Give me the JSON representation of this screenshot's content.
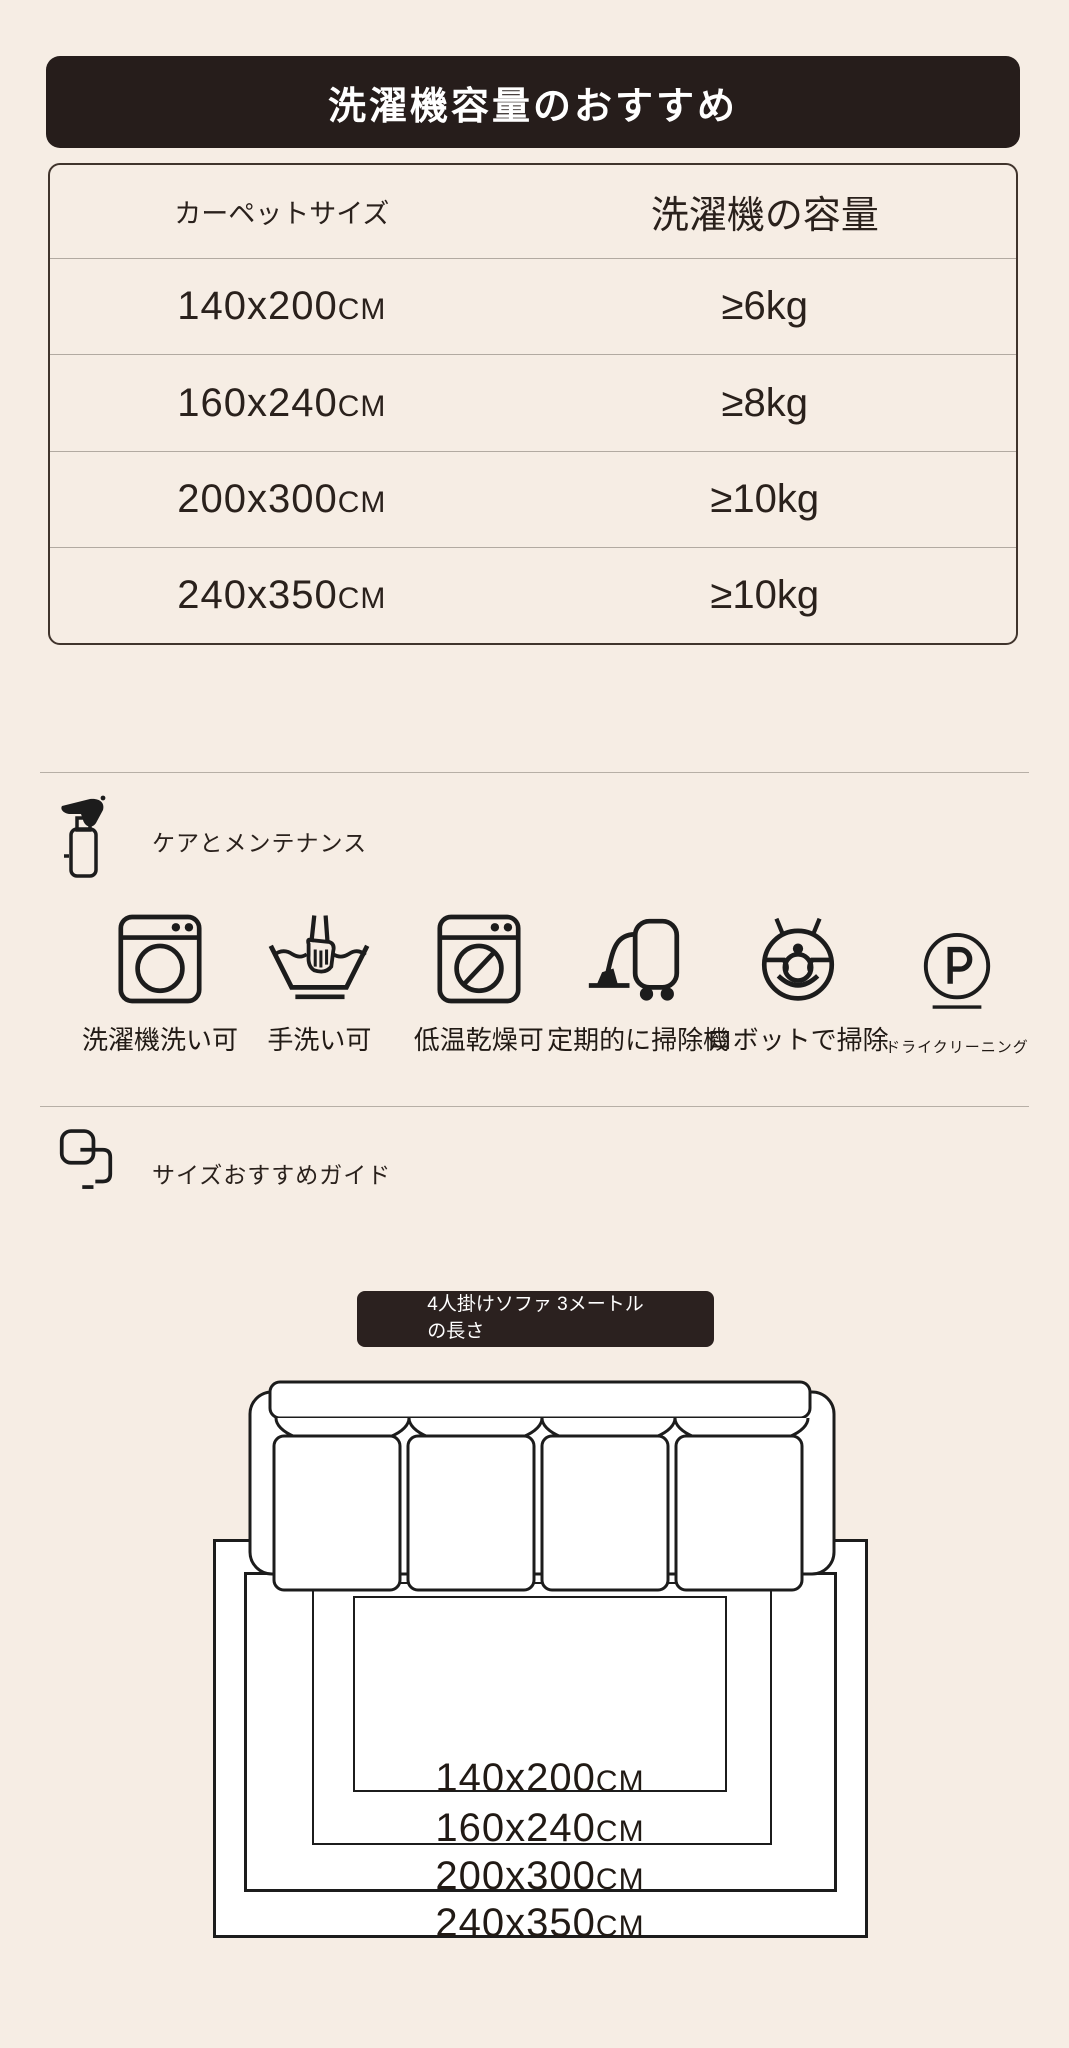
{
  "colors": {
    "background": "#f6ede4",
    "banner_bg": "#261d1b",
    "tooltip_bg": "#2b211f",
    "text": "#2a211c",
    "line": "#b7afa6"
  },
  "banner": {
    "title": "洗濯機容量のおすすめ"
  },
  "table": {
    "columns": {
      "size": "カーペットサイズ",
      "capacity": "洗濯機の容量"
    },
    "rows": [
      {
        "size": "140x200",
        "unit": "CM",
        "capacity": "≥6kg"
      },
      {
        "size": "160x240",
        "unit": "CM",
        "capacity": "≥8kg"
      },
      {
        "size": "200x300",
        "unit": "CM",
        "capacity": "≥10kg"
      },
      {
        "size": "240x350",
        "unit": "CM",
        "capacity": "≥10kg"
      }
    ]
  },
  "care": {
    "title": "ケアとメンテナンス",
    "items": [
      {
        "icon": "washing-machine-icon",
        "label": "洗濯機洗い可"
      },
      {
        "icon": "hand-wash-icon",
        "label": "手洗い可"
      },
      {
        "icon": "tumble-dry-low-icon",
        "label": "低温乾燥可"
      },
      {
        "icon": "vacuum-cleaner-icon",
        "label": "定期的に掃除機"
      },
      {
        "icon": "robot-vacuum-icon",
        "label": "ロボットで掃除"
      },
      {
        "icon": "dry-cleaning-icon",
        "label": "ドライクリーニング"
      }
    ]
  },
  "size_guide": {
    "title": "サイズおすすめガイド",
    "sofa_note": "4人掛けソファ 3メートル\nの長さ",
    "carpets": [
      {
        "size": "140x200",
        "unit": "CM"
      },
      {
        "size": "160x240",
        "unit": "CM"
      },
      {
        "size": "200x300",
        "unit": "CM"
      },
      {
        "size": "240x350",
        "unit": "CM"
      }
    ]
  }
}
